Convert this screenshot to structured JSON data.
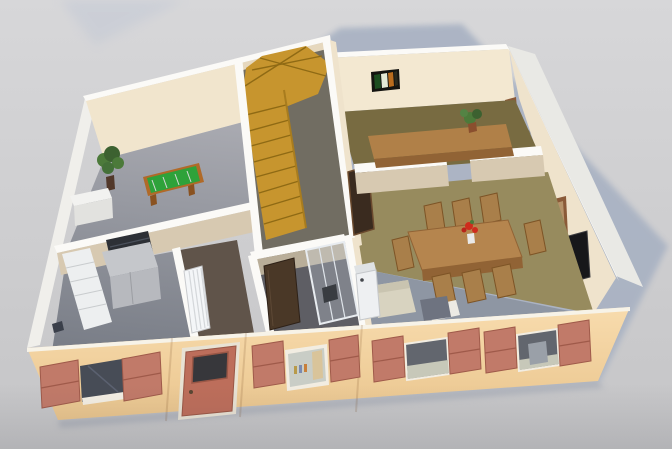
{
  "viewport": {
    "kind": "3d-dollhouse-render",
    "description": "Aerial cutaway view of a one-storey house interior with peach exterior walls, salmon shutters and a shadow cast on grey ground",
    "width_px": 672,
    "height_px": 449
  },
  "scene": {
    "rooms": [
      {
        "name": "games-room",
        "position": "back-left",
        "floor": "grey tile",
        "items": [
          "potted-plant",
          "table-football-table",
          "white-sideboard"
        ]
      },
      {
        "name": "kitchen",
        "position": "front-left",
        "floor": "grey tile",
        "items": [
          "white-cabinet-row",
          "island-counter-with-dark-cooktop",
          "dark-floor-object"
        ]
      },
      {
        "name": "entrance-hall",
        "position": "behind-front-door",
        "floor": "dark wood",
        "items": [
          "white-radiator"
        ]
      },
      {
        "name": "stair-hall",
        "position": "centre-back",
        "floor": "grey-brown",
        "items": [
          "golden-wood-winder-staircase"
        ]
      },
      {
        "name": "bathroom",
        "position": "centre-front",
        "floor": "dark tile",
        "items": [
          "glass-shower-cabin",
          "open-dark-door",
          "white-appliance"
        ]
      },
      {
        "name": "study",
        "position": "back-right",
        "floor": "brown wood",
        "items": [
          "long-desk",
          "desk-plant",
          "striped-wall-picture",
          "small-wall-frame",
          "wall-clock"
        ]
      },
      {
        "name": "dining-room",
        "position": "right",
        "floor": "olive carpet",
        "items": [
          "wooden-dining-table",
          "eight-wooden-chairs",
          "red-flower-centrepiece",
          "wall-tv",
          "wall-picture-frame"
        ]
      },
      {
        "name": "living-area",
        "position": "front-right",
        "floor": "blue-grey tile",
        "items": [
          "beige-sofa",
          "grey-ottoman",
          "white-coffee-table",
          "grey-side-cube"
        ]
      }
    ],
    "facade": {
      "door": {
        "style": "salmon panel door with dark glass pane and round handle",
        "position": "left of centre"
      },
      "windows": [
        {
          "id": 1,
          "glazing": "dark glass",
          "shutters": "open salmon pair"
        },
        {
          "id": 2,
          "glazing": "white frame, bottles and tan curtain visible",
          "shutters": "open salmon pair"
        },
        {
          "id": 3,
          "glazing": "open aperture showing sofa cushions",
          "shutters": "open salmon pair"
        },
        {
          "id": 4,
          "glazing": "open aperture showing side cube and cushions",
          "shutters": "open salmon pair"
        }
      ]
    },
    "lighting": {
      "shadow": "large blue-grey shadow cast behind and to the right of the house"
    }
  },
  "colors": {
    "bg_top": "#d7d7d9",
    "bg_bottom": "#c5c5c7",
    "shadow": "#a9b2c3",
    "ground_shadow": "#9aa0ae",
    "ext_left_wall": "#f0efeb",
    "ext_right_wall": "#e9e9e5",
    "wall_top": "#fbfaf7",
    "wall_lit": "#f3e8d1",
    "wall_cream": "#efe3cc",
    "wall_shade": "#d7c9b1",
    "wall_dark": "#b9ae99",
    "facade_light": "#f8dcae",
    "facade_dark": "#e9c48c",
    "shutter": "#c17a69",
    "shutter_edge": "#9f5a4a",
    "door": "#bd6e5b",
    "door_glass": "#37373b",
    "glass_dark": "#474c56",
    "aperture_dark": "#62666e",
    "cushion": "#c7c8b9",
    "tile_light": "#a8a9b0",
    "tile_dark": "#70757f",
    "floor_entry": "#60544a",
    "floor_hall": "#716d62",
    "floor_office": "#786b41",
    "floor_dining": "#978b5e",
    "floor_living": "#8e96a3",
    "floor_bath": "#5e5e64",
    "stairs": "#c7952e",
    "stairs_line": "#8f6a14",
    "wood": "#b5854e",
    "wood_dark": "#916335",
    "chair_wood": "#a97f4a",
    "pool_green": "#2ea23a",
    "pool_frame": "#b06a28",
    "cabinet": "#edeff0",
    "island": "#b7b9be",
    "cooktop": "#2d3036",
    "radiator": "#f4f6f8",
    "washer": "#eef0f2",
    "sofa": "#d8d3c0",
    "ottoman": "#6e7380",
    "tv": "#17171a",
    "frame_pic": "#8a5a38",
    "plant": "#4c7a3a",
    "pot": "#52382a",
    "flower": "#cf2c1d",
    "doorway_dark": "#3a2b1f",
    "bath_door": "#4a3827"
  }
}
